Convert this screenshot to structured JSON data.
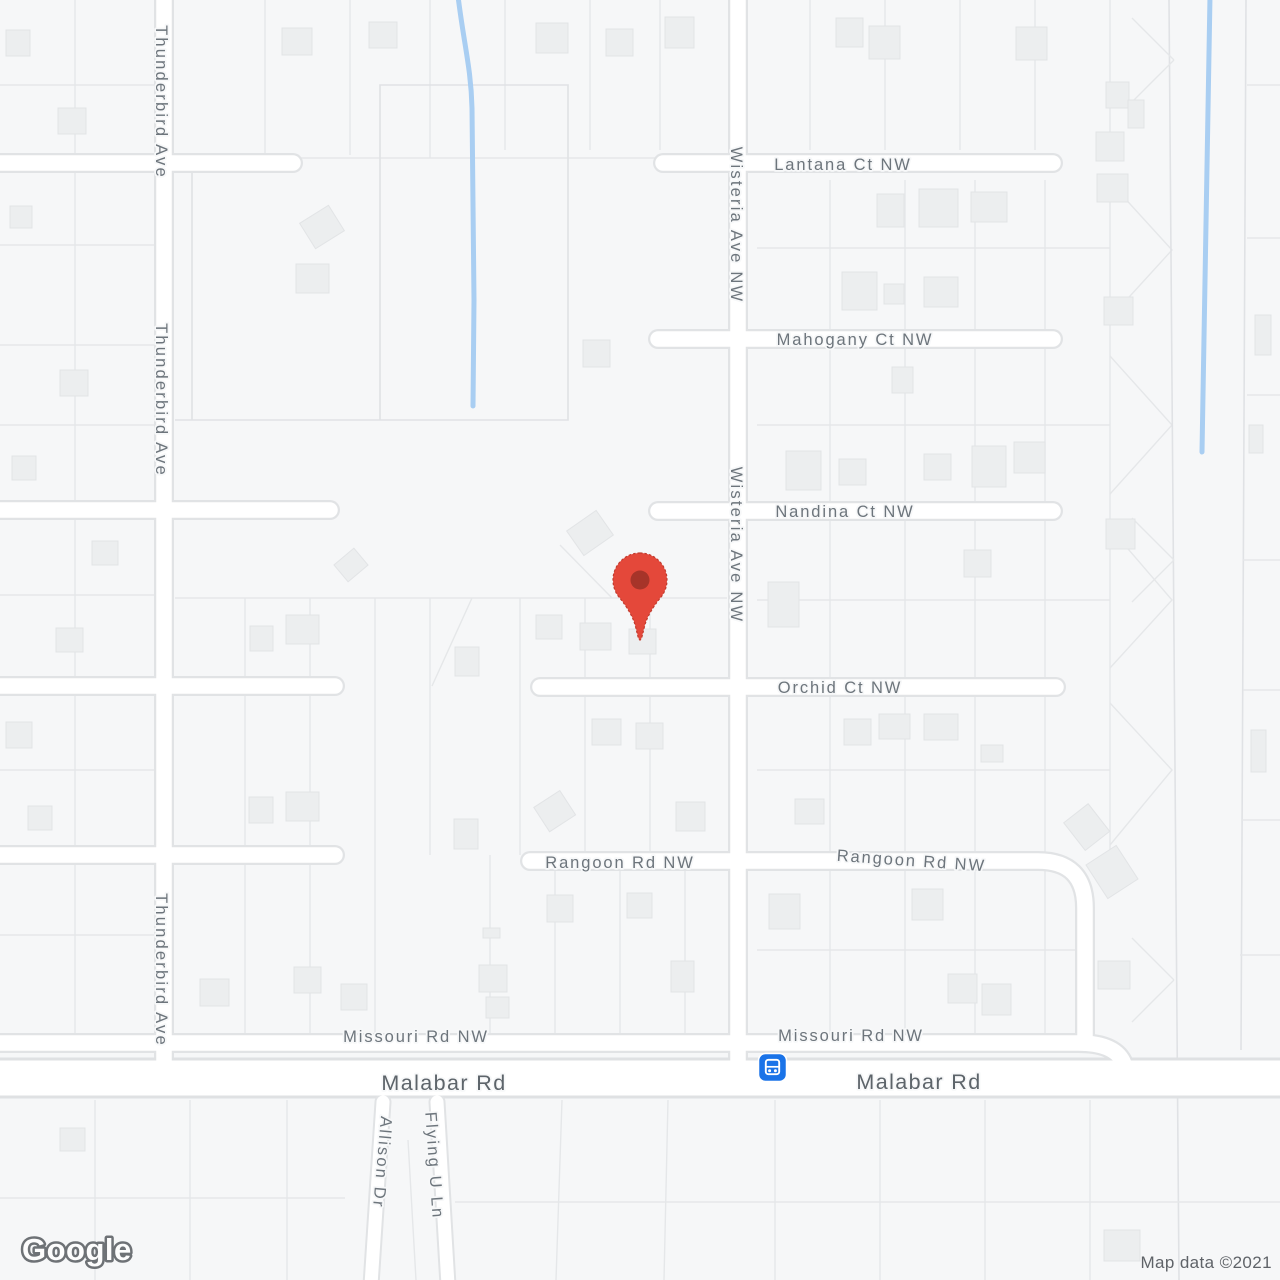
{
  "map": {
    "type": "google-maps-static-view",
    "watermark": "Google",
    "copyright": "Map data ©2021"
  },
  "colors": {
    "background": "#F6F7F8",
    "road_fill": "#FFFFFF",
    "road_casing": "#E1E3E5",
    "parcel_line": "#E5E7E9",
    "building_fill": "#ECEEEF",
    "water_blue": "#A9CEF2",
    "label_gray": "#6D757C",
    "label_dark": "#5D646A",
    "pin_red": "#E4483A",
    "pin_inner_red": "#A63429",
    "transit_blue": "#1A73E8"
  },
  "marker": {
    "name": "location-pin",
    "shape": "google-maps-red-pin"
  },
  "transit_stop": {
    "name": "bus-stop",
    "glyph": "bus"
  },
  "street_labels": [
    {
      "id": "lantana",
      "text": "Lantana Ct NW"
    },
    {
      "id": "mahogany",
      "text": "Mahogany Ct NW"
    },
    {
      "id": "nandina",
      "text": "Nandina Ct NW"
    },
    {
      "id": "orchid",
      "text": "Orchid Ct NW"
    },
    {
      "id": "rangoon-west",
      "text": "Rangoon Rd NW"
    },
    {
      "id": "rangoon-east",
      "text": "Rangoon Rd NW"
    },
    {
      "id": "missouri-west",
      "text": "Missouri Rd NW"
    },
    {
      "id": "missouri-east",
      "text": "Missouri Rd NW"
    },
    {
      "id": "malabar-west",
      "text": "Malabar Rd"
    },
    {
      "id": "malabar-east",
      "text": "Malabar Rd"
    },
    {
      "id": "wisteria-north",
      "text": "Wisteria Ave NW"
    },
    {
      "id": "wisteria-south",
      "text": "Wisteria Ave NW"
    },
    {
      "id": "thunderbird-north",
      "text": "Thunderbird Ave"
    },
    {
      "id": "thunderbird-mid",
      "text": "Thunderbird Ave"
    },
    {
      "id": "thunderbird-south",
      "text": "Thunderbird Ave"
    },
    {
      "id": "allison",
      "text": "Allison Dr"
    },
    {
      "id": "flying-u",
      "text": "Flying U Ln"
    }
  ]
}
